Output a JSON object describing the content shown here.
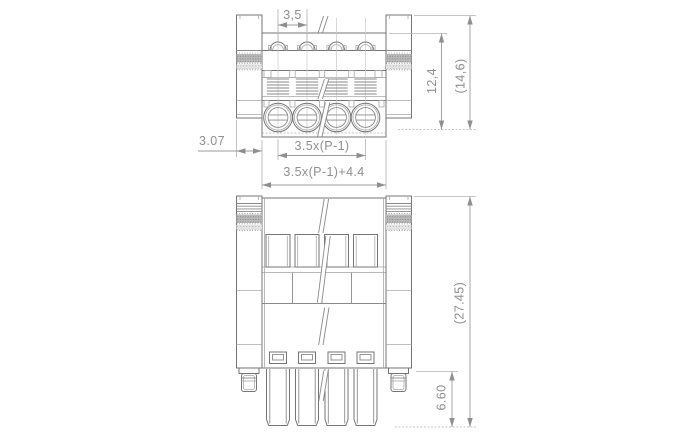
{
  "dimensions": {
    "pitch": "3,5",
    "body_height": "12,4",
    "overall_height_top": "(14,6)",
    "edge_offset": "3.07",
    "center_span": "3.5x(P-1)",
    "overall_width": "3.5x(P-1)+4.4",
    "overall_height_front": "(27.45)",
    "pin_length": "6.60"
  },
  "colors": {
    "outline": "#757575",
    "dimension_line": "#9b9b9b",
    "label_text": "#8f8f8f",
    "knurl_band": "#b9b9b9",
    "background": "#ffffff"
  }
}
